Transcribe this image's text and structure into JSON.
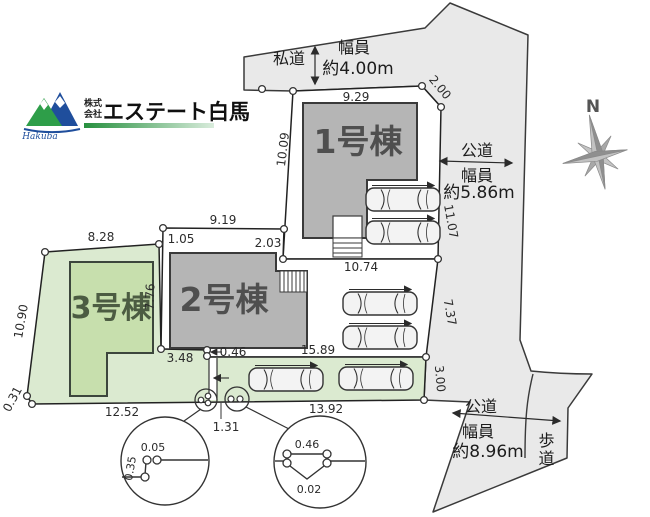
{
  "logo": {
    "company_type_top": "株式",
    "company_type_bottom": "会社",
    "company_name": "エステート白馬",
    "script": "Hakuba"
  },
  "compass": {
    "north": "N"
  },
  "roads": {
    "private": {
      "name": "私道",
      "width_caption": "幅員",
      "width_value": "約4.00m"
    },
    "public_east": {
      "name": "公道",
      "width_caption": "幅員",
      "width_value": "約5.86m"
    },
    "public_south": {
      "name": "公道",
      "width_caption": "幅員",
      "width_value": "約8.96m"
    },
    "sidewalk": {
      "name": "歩道"
    }
  },
  "buildings": {
    "b1": "1号棟",
    "b2": "2号棟",
    "b3": "3号棟"
  },
  "dimensions": {
    "lot1": {
      "top": "9.29",
      "left": "10.09",
      "right_upper": "2.00",
      "right": "11.07",
      "bottom": "10.74"
    },
    "lot2": {
      "top": "9.19",
      "left_upper": "1.05",
      "right_upper": "2.03",
      "left": "7.76",
      "bottom_left": "3.48",
      "jog": "0.46",
      "bottom": "15.89",
      "right": "7.37"
    },
    "lot3": {
      "top": "8.28",
      "left": "10.90",
      "corner": "0.31",
      "bottom": "12.52",
      "strip_bottom": "13.92",
      "strip_right": "3.00",
      "passage": "1.31"
    },
    "detail_left": {
      "h": "0.05",
      "v": "0.35"
    },
    "detail_right": {
      "top": "0.46",
      "bottom": "0.02"
    }
  },
  "colors": {
    "road_fill": "#e9e9e9",
    "building_gray": "#b5b5b5",
    "lot_green": "#dbead0",
    "building_green": "#c7dfad",
    "line": "#333333",
    "logo_blue": "#1f4e9c",
    "logo_green": "#2e9e49"
  }
}
